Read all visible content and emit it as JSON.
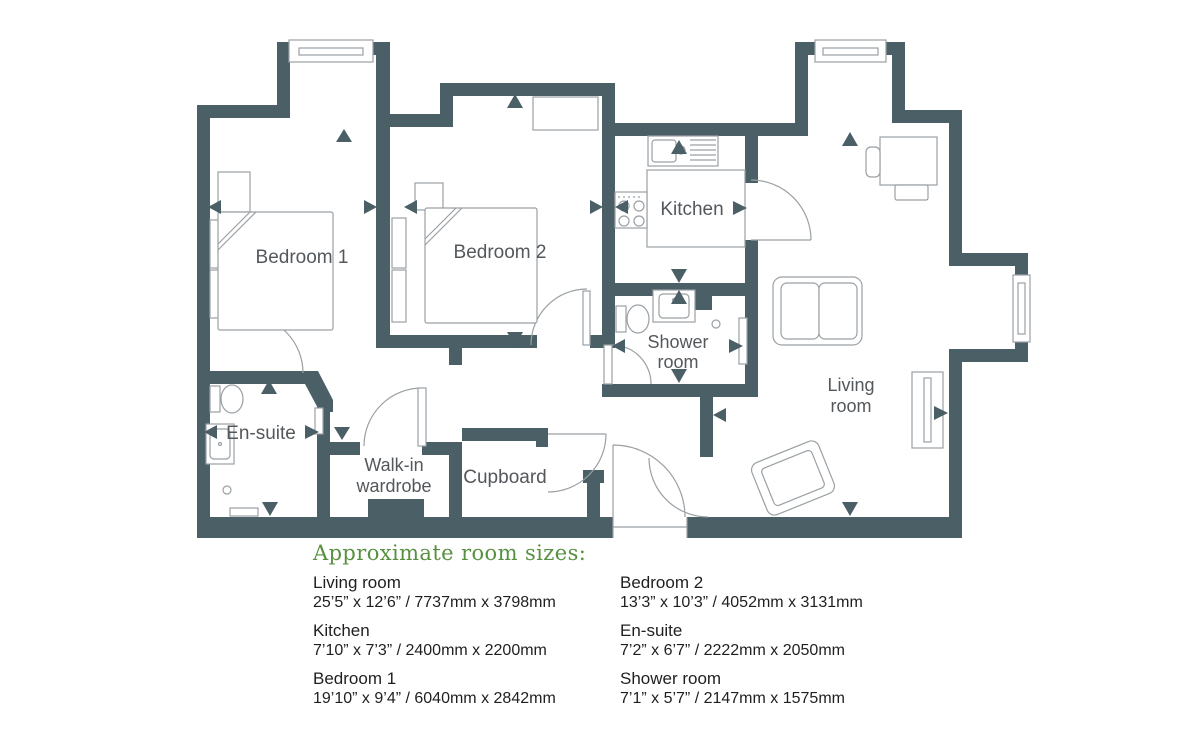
{
  "plan": {
    "labels": {
      "bedroom1": "Bedroom 1",
      "bedroom2": "Bedroom 2",
      "kitchen": "Kitchen",
      "shower_line1": "Shower",
      "shower_line2": "room",
      "living_line1": "Living",
      "living_line2": "room",
      "ensuite": "En-suite",
      "walkin_line1": "Walk-in",
      "walkin_line2": "wardrobe",
      "cupboard": "Cupboard"
    },
    "colors": {
      "wall": "#4a5f66",
      "room_label": "#53585c",
      "furniture_line": "#9aa0a4",
      "heading_green": "#579140"
    }
  },
  "sizes": {
    "heading": "Approximate room sizes:",
    "columns": [
      {
        "items": [
          {
            "name": "Living room",
            "dims": "25’5” x 12’6” / 7737mm x 3798mm"
          },
          {
            "name": "Kitchen",
            "dims": "7’10” x 7’3” / 2400mm x 2200mm"
          },
          {
            "name": "Bedroom 1",
            "dims": "19’10” x 9’4” / 6040mm x 2842mm"
          }
        ]
      },
      {
        "items": [
          {
            "name": "Bedroom 2",
            "dims": "13’3” x 10’3” / 4052mm x 3131mm"
          },
          {
            "name": "En-suite",
            "dims": "7’2” x 6’7” / 2222mm x 2050mm"
          },
          {
            "name": "Shower room",
            "dims": "7’1” x 5’7” / 2147mm x 1575mm"
          }
        ]
      }
    ]
  }
}
